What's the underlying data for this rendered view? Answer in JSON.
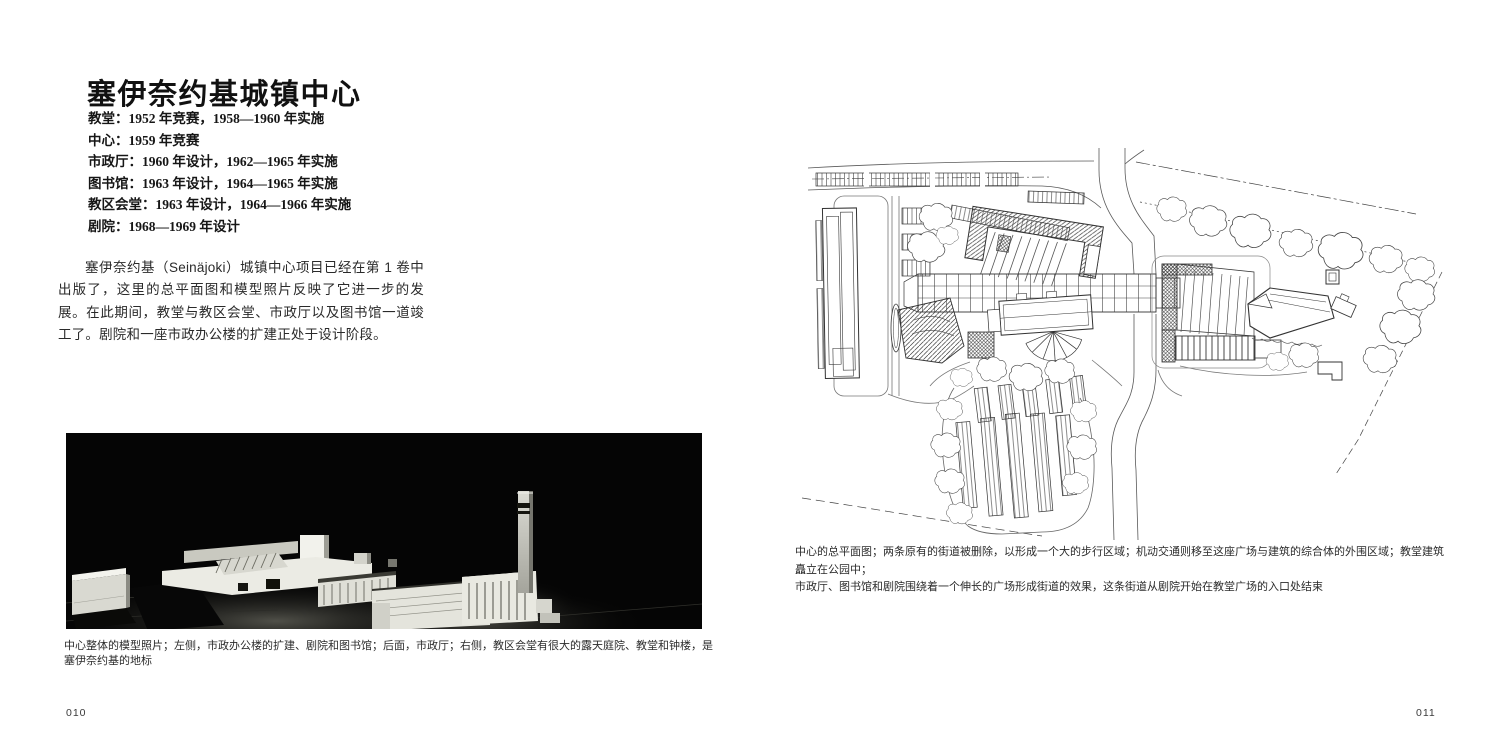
{
  "colors": {
    "paper": "#ffffff",
    "ink": "#1d1d1d",
    "photo_background": "#050505"
  },
  "page_left": {
    "title": "塞伊奈约基城镇中心",
    "project_dates": [
      "教堂：1952 年竞赛，1958—1960 年实施",
      "中心：1959 年竞赛",
      "市政厅：1960 年设计，1962—1965 年实施",
      "图书馆：1963 年设计，1964—1965 年实施",
      "教区会堂：1963 年设计，1964—1966 年实施",
      "剧院：1968—1969 年设计"
    ],
    "intro_paragraph": "塞伊奈约基（Seinäjoki）城镇中心项目已经在第 1 卷中出版了，这里的总平面图和模型照片反映了它进一步的发展。在此期间，教堂与教区会堂、市政厅以及图书馆一道竣工了。剧院和一座市政办公楼的扩建正处于设计阶段。",
    "photo_caption": "中心整体的模型照片；左侧，市政办公楼的扩建、剧院和图书馆；后面，市政厅；右侧，教区会堂有很大的露天庭院、教堂和钟楼，是塞伊奈约基的地标",
    "page_number": "010"
  },
  "page_right": {
    "plan_caption_line1": "中心的总平面图；两条原有的街道被删除，以形成一个大的步行区域；机动交通则移至这座广场与建筑的综合体的外围区域；教堂建筑矗立在公园中；",
    "plan_caption_line2": "市政厅、图书馆和剧院围绕着一个伸长的广场形成街道的效果，这条街道从剧院开始在教堂广场的入口处结束",
    "page_number": "011"
  }
}
